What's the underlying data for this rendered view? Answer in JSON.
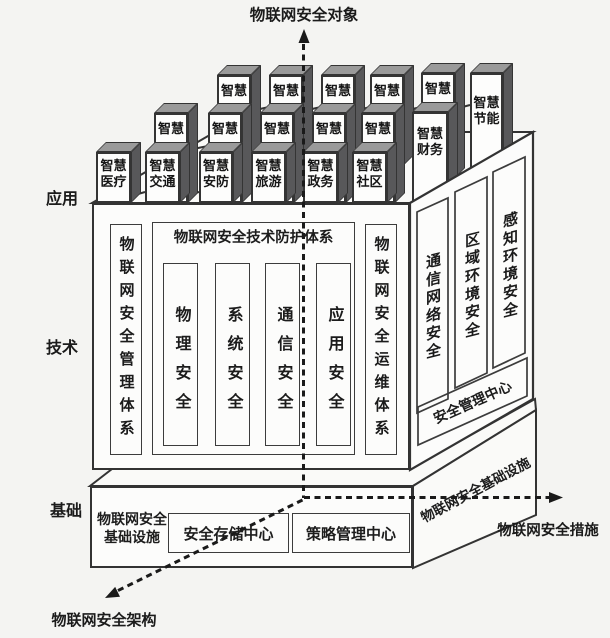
{
  "labels": {
    "top_axis": "物联网安全对象",
    "application": "应用",
    "technology": "技术",
    "foundation": "基础",
    "architecture": "物联网安全架构",
    "measures": "物联网安全措施"
  },
  "smart_boxes": {
    "front_row": [
      "智慧\n医疗",
      "智慧\n交通",
      "智慧\n安防",
      "智慧\n旅游",
      "智慧\n政务",
      "智慧\n社区"
    ],
    "middle_row": [
      "智慧",
      "智慧",
      "智慧",
      "智慧",
      "智慧",
      "智慧\n财务"
    ],
    "back_row": [
      "智慧",
      "智慧",
      "智慧",
      "智慧",
      "智慧",
      "智慧\n节能"
    ]
  },
  "tech": {
    "management_column": "物联网安全管理体系",
    "protection_title": "物联网安全技术防护体系",
    "protection_columns": [
      "物理安全",
      "系统安全",
      "通信安全",
      "应用安全"
    ],
    "operation_column": "物联网安全运维体系",
    "side_columns": [
      "通信网络安全",
      "区域环境安全",
      "感知环境安全"
    ],
    "side_bar": "安全管理中心"
  },
  "foundation": {
    "front_label": "物联网安全\n基础设施",
    "storage_center": "安全存储中心",
    "policy_center": "策略管理中心",
    "side_label": "物联网安全基础设施"
  },
  "colors": {
    "line": "#333333",
    "box_top_face": "#9a9a9a",
    "box_side_face": "#58585a",
    "face": "#fcfcfb",
    "background": "#f4f4f2"
  }
}
